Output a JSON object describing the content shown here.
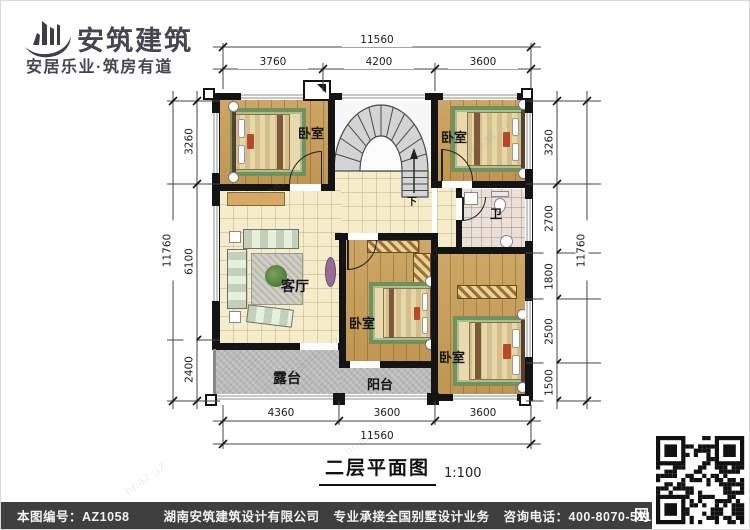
{
  "brand": {
    "name": "安筑建筑",
    "tagline": "安居乐业·筑房有道"
  },
  "plan": {
    "title": "二层平面图",
    "scale": "1:100",
    "rooms": {
      "bedroom": "卧室",
      "living": "客厅",
      "bath": "卫",
      "terrace": "露台",
      "balcony": "阳台",
      "stair_down": "下"
    },
    "dimensions": {
      "top_total": "11560",
      "top_segments": [
        "3760",
        "4200",
        "3600"
      ],
      "bottom_segments": [
        "4360",
        "3600",
        "3600"
      ],
      "bottom_total": "11560",
      "left_total": "11760",
      "left_segments": [
        "3260",
        "6100",
        "2400"
      ],
      "right_segments": [
        "3260",
        "2700",
        "1800",
        "2500",
        "1500"
      ],
      "right_total": "11760"
    }
  },
  "footer": {
    "drawing_no": "本图编号：AZ1058",
    "company": "湖南安筑建筑设计有限公司",
    "service": "专业承接全国别墅设计业务",
    "phone": "咨询电话：400-8070-511",
    "web_badge": "网"
  },
  "watermark": "hnaz_jz",
  "colors": {
    "wall": "#141414",
    "wood": "#c8a262",
    "tile_cream": "#f4ecca",
    "concrete": "#b9b9b9",
    "footer_bg": "#3f3f3f",
    "brand_text": "#46464f"
  }
}
